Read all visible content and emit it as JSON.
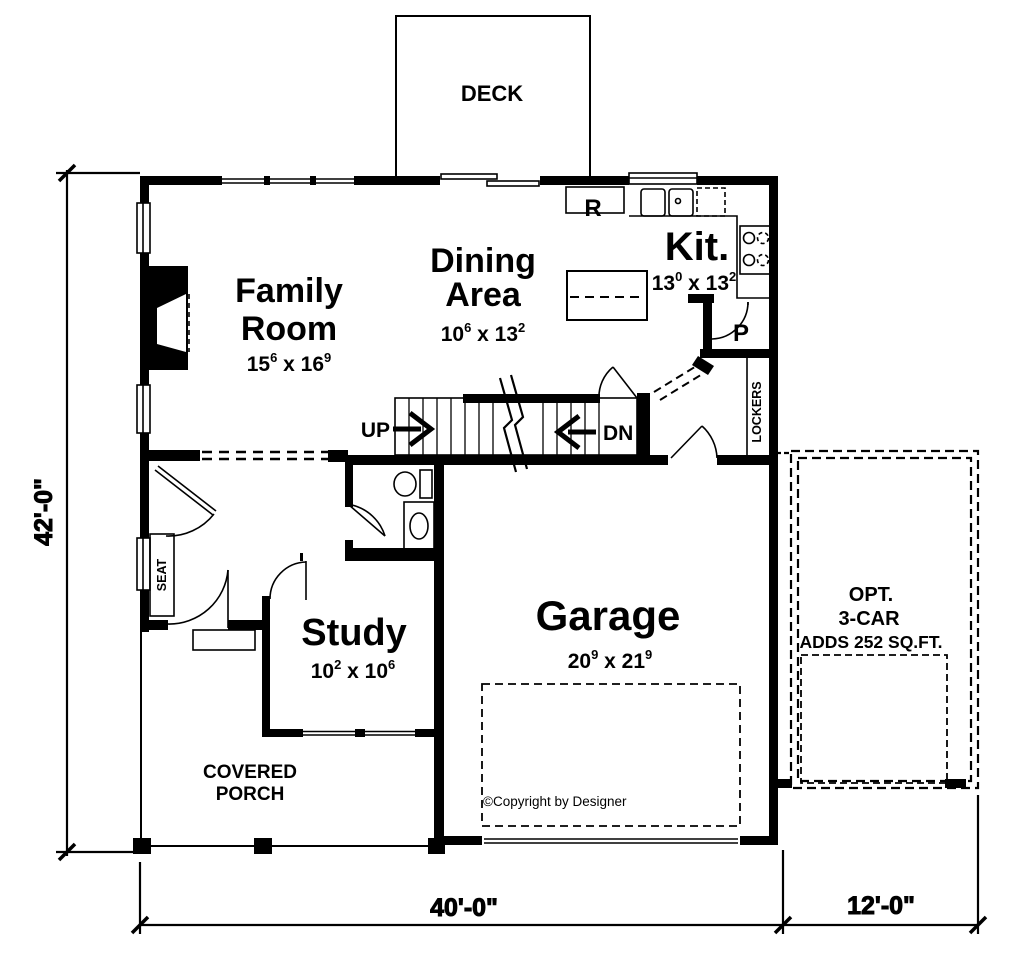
{
  "plan": {
    "deck_label": "DECK",
    "family": {
      "line1": "Family",
      "line2": "Room",
      "w": "15",
      "wi": "6",
      "sep": " x ",
      "h": "16",
      "hi": "9"
    },
    "dining": {
      "line1": "Dining",
      "line2": "Area",
      "w": "10",
      "wi": "6",
      "sep": " x ",
      "h": "13",
      "hi": "2"
    },
    "kitchen": {
      "label": "Kit.",
      "w": "13",
      "wi": "0",
      "sep": " x ",
      "h": "13",
      "hi": "2",
      "fridge": "R",
      "pantry": "P"
    },
    "study": {
      "label": "Study",
      "w": "10",
      "wi": "2",
      "sep": " x ",
      "h": "10",
      "hi": "6"
    },
    "garage": {
      "label": "Garage",
      "w": "20",
      "wi": "9",
      "sep": " x ",
      "h": "21",
      "hi": "9",
      "copyright": "©Copyright by Designer"
    },
    "stairs": {
      "up": "UP",
      "dn": "DN"
    },
    "mudroom": {
      "lockers": "LOCKERS"
    },
    "foyer": {
      "seat": "SEAT"
    },
    "porch": {
      "line1": "COVERED",
      "line2": "PORCH"
    },
    "opt_garage": {
      "line1": "OPT.",
      "line2": "3-CAR",
      "line3": "ADDS 252 SQ.FT."
    },
    "dims": {
      "left": "42'-0\"",
      "bottom": "40'-0\"",
      "right": "12'-0\""
    },
    "colors": {
      "ink": "#000000",
      "paper": "#ffffff"
    }
  }
}
